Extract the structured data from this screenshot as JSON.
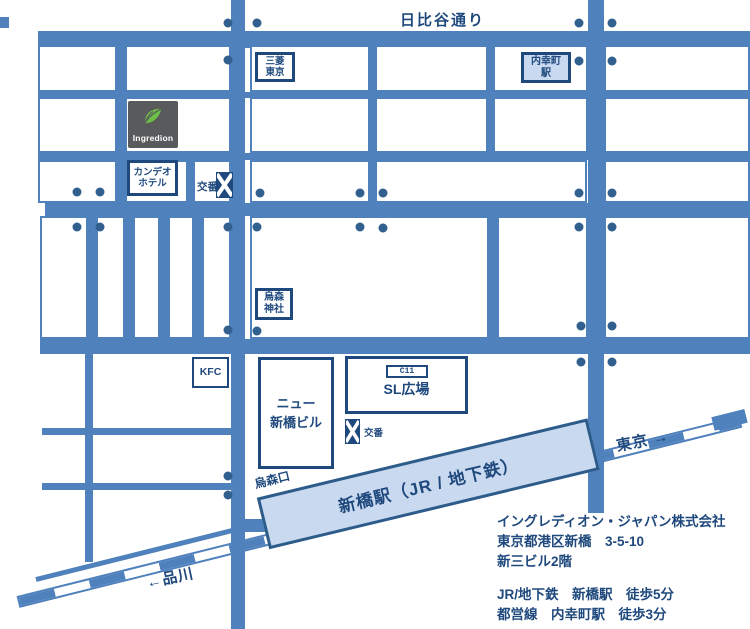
{
  "colors": {
    "road_blue": "#4f81bd",
    "navy_border": "#1f497d",
    "text_navy": "#1f497d",
    "station_fill": "#c9d9ef",
    "dot_blue": "#31608f",
    "logo_gray": "#595a5c",
    "logo_green": "#6cbf47"
  },
  "road_labels": {
    "hibiya_dori": "日比谷通り",
    "karasumori_exit": "烏森口",
    "to_tokyo": "東京 →",
    "to_shinagawa": "←品川"
  },
  "landmarks": {
    "mitsubishi_tokyo": "三菱\n東京",
    "uchisaiwaicho_station": "内幸町\n駅",
    "ingredion_logo_text": "Ingredion",
    "candeo_hotel": "カンデオ\nホテル",
    "koban_upper": "交番",
    "karasumori_shrine": "烏森\n神社",
    "kfc": "KFC",
    "new_shimbashi_building": "ニュー\n新橋ビル",
    "sl_square_code": "C11",
    "sl_square": "SL広場",
    "koban_lower": "交番",
    "shimbashi_station": "新橋駅（JR / 地下鉄）"
  },
  "info": {
    "company": "イングレディオン・ジャパン株式会社",
    "address_line1": "東京都港区新橋　3-5-10",
    "address_line2": "新三ビル2階",
    "access_line1": "JR/地下鉄　新橋駅　徒歩5分",
    "access_line2": "都営線　内幸町駅　徒歩3分"
  },
  "geometry": {
    "roads": [
      [
        38,
        31,
        712,
        17
      ],
      [
        38,
        92,
        712,
        6
      ],
      [
        38,
        153,
        712,
        7
      ],
      [
        45,
        203,
        705,
        13
      ],
      [
        40,
        339,
        710,
        15
      ],
      [
        42,
        428,
        193,
        7
      ],
      [
        42,
        483,
        193,
        7
      ],
      [
        231,
        0,
        14,
        629
      ],
      [
        588,
        0,
        16,
        513
      ],
      [
        117,
        45,
        8,
        158
      ],
      [
        188,
        158,
        6,
        45
      ],
      [
        88,
        216,
        8,
        123
      ],
      [
        125,
        216,
        8,
        123
      ],
      [
        160,
        216,
        8,
        123
      ],
      [
        194,
        216,
        8,
        123
      ],
      [
        370,
        45,
        7,
        158
      ],
      [
        488,
        45,
        7,
        108
      ],
      [
        489,
        216,
        8,
        123
      ],
      [
        85,
        354,
        8,
        208
      ],
      [
        0,
        17,
        9,
        11
      ],
      [
        245,
        519,
        22,
        13
      ],
      [
        572,
        429,
        17,
        14
      ]
    ],
    "blocks": [
      [
        38,
        45,
        79,
        47
      ],
      [
        125,
        45,
        106,
        47
      ],
      [
        250,
        45,
        120,
        47
      ],
      [
        375,
        45,
        113,
        47
      ],
      [
        493,
        45,
        95,
        47
      ],
      [
        604,
        45,
        146,
        47
      ],
      [
        38,
        97,
        79,
        56
      ],
      [
        125,
        97,
        106,
        56
      ],
      [
        250,
        97,
        120,
        56
      ],
      [
        375,
        97,
        113,
        56
      ],
      [
        493,
        97,
        95,
        56
      ],
      [
        604,
        97,
        146,
        56
      ],
      [
        38,
        160,
        79,
        43
      ],
      [
        125,
        160,
        63,
        43
      ],
      [
        193,
        160,
        38,
        43
      ],
      [
        250,
        160,
        120,
        43
      ],
      [
        375,
        160,
        212,
        43
      ],
      [
        604,
        160,
        146,
        43
      ],
      [
        40,
        216,
        48,
        123
      ],
      [
        96,
        216,
        29,
        123
      ],
      [
        133,
        216,
        27,
        123
      ],
      [
        168,
        216,
        26,
        123
      ],
      [
        202,
        216,
        29,
        123
      ],
      [
        250,
        216,
        239,
        123
      ],
      [
        497,
        216,
        91,
        123
      ],
      [
        604,
        216,
        146,
        123
      ]
    ],
    "dots": [
      [
        228,
        23
      ],
      [
        257,
        23
      ],
      [
        579,
        23
      ],
      [
        612,
        23
      ],
      [
        228,
        60
      ],
      [
        579,
        61
      ],
      [
        612,
        61
      ],
      [
        77,
        192
      ],
      [
        100,
        192
      ],
      [
        260,
        193
      ],
      [
        360,
        193
      ],
      [
        383,
        193
      ],
      [
        579,
        193
      ],
      [
        612,
        193
      ],
      [
        77,
        227
      ],
      [
        100,
        227
      ],
      [
        228,
        227
      ],
      [
        257,
        227
      ],
      [
        360,
        227
      ],
      [
        383,
        228
      ],
      [
        579,
        227
      ],
      [
        612,
        227
      ],
      [
        228,
        330
      ],
      [
        257,
        331
      ],
      [
        581,
        326
      ],
      [
        612,
        326
      ],
      [
        581,
        362
      ],
      [
        612,
        362
      ],
      [
        228,
        476
      ],
      [
        228,
        495
      ]
    ]
  }
}
